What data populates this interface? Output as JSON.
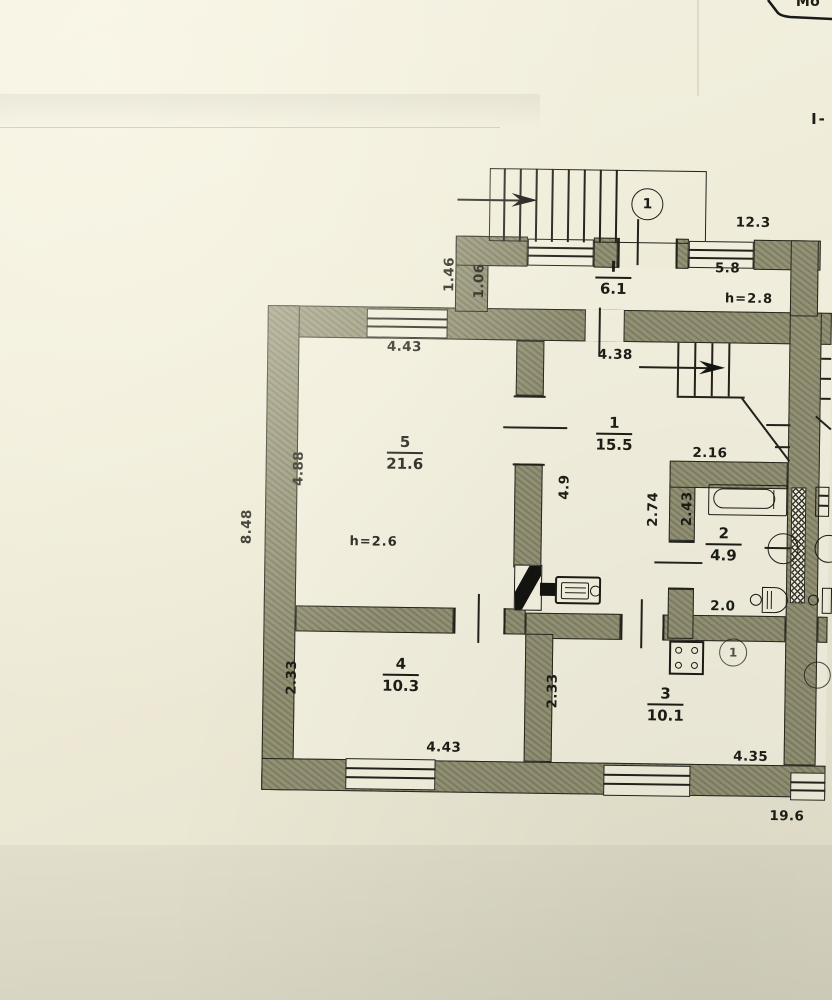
{
  "meta": {
    "stamp_text": "Мо",
    "section_mark": "I-"
  },
  "markers": {
    "entrance": "1",
    "room3_meter": "1"
  },
  "rooms": {
    "vestibule": {
      "num": "I",
      "area": "6.1",
      "height_note": "h=2.8"
    },
    "room1": {
      "num": "1",
      "area": "15.5"
    },
    "room2": {
      "num": "2",
      "area": "4.9"
    },
    "room3": {
      "num": "3",
      "area": "10.1"
    },
    "room4": {
      "num": "4",
      "area": "10.3"
    },
    "room5": {
      "num": "5",
      "area": "21.6",
      "height_note": "h=2.6"
    }
  },
  "dimensions": {
    "top_right_width": "12.3",
    "vestibule_width": "5.8",
    "porch_side_outer": "1.46",
    "porch_side_inner": "1.06",
    "room1_top_width": "4.38",
    "room5_top_width": "4.43",
    "room5_left_height": "4.88",
    "left_overall_height": "8.48",
    "room1_left_height": "4.9",
    "room2_top_width": "2.16",
    "room1_right_height": "2.74",
    "room2_left_height": "2.43",
    "room2_bottom_width": "2.0",
    "room4_left_height": "2.33",
    "room3_left_height": "2.33",
    "room4_bottom_width": "4.43",
    "room3_bottom_width": "4.35",
    "bottom_overall_width": "19.6"
  },
  "colors": {
    "wall_fill": "#8d8b6d",
    "paper": "#edead6",
    "line": "#22221b",
    "interior": "#f1eedd"
  }
}
